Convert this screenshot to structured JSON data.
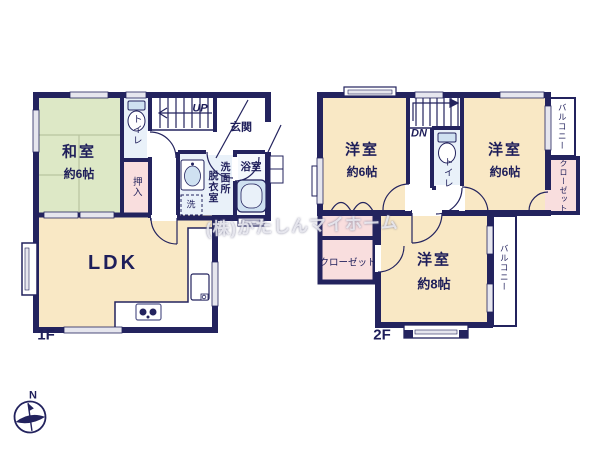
{
  "floor1": {
    "label": "1F",
    "washitsu": {
      "name": "和室",
      "size": "約6帖"
    },
    "toilet": "トイレ",
    "oshiire": "押入",
    "entrance": "玄関",
    "stairs_direction": "UP",
    "dressing_room": "脱衣室",
    "washroom": "洗面所",
    "washer": "洗",
    "bath": "浴室",
    "ldk": "LDK"
  },
  "floor2": {
    "label": "2F",
    "western_left": {
      "name": "洋室",
      "size": "約6帖"
    },
    "western_right": {
      "name": "洋室",
      "size": "約6帖"
    },
    "western_main": {
      "name": "洋室",
      "size": "約8帖"
    },
    "toilet": "トイレ",
    "stairs_direction": "DN",
    "balcony_top": "バルコニー",
    "balcony_side": "バルコニー",
    "closet_right": "クローゼット",
    "closet_main": "クローゼット"
  },
  "compass": {
    "north": "N"
  },
  "watermark": "(株)かたしんマイホーム",
  "colors": {
    "wall": "#23235e",
    "tatami_floor": "#dde8c6",
    "wood_floor": "#f9e8c5",
    "closet_floor": "#f9dede",
    "wet_floor": "#e9f1f9",
    "fixture": "#cfe1f1",
    "window": "#e6e6ee",
    "text": "#1e1e5a",
    "background": "#ffffff"
  }
}
